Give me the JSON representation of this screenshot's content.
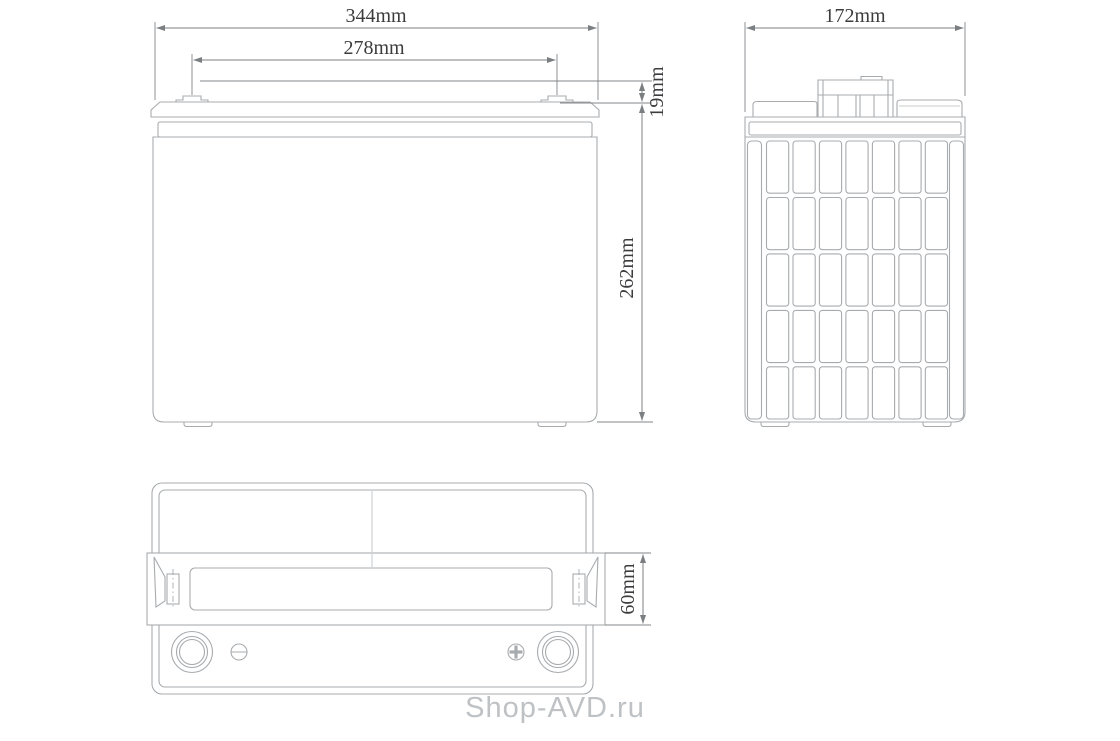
{
  "watermark": {
    "text": "Shop-AVD.ru",
    "color": "#bfc2c5"
  },
  "colors": {
    "background": "#ffffff",
    "drawing_line": "#a8abae",
    "dimension_line": "#7c7f82",
    "dimension_text": "#3c3c3e"
  },
  "views": {
    "front_view": {
      "dimensions": {
        "overall_width": "344mm",
        "terminal_center_spacing": "278mm",
        "terminal_height": "19mm",
        "container_height": "262mm"
      }
    },
    "side_view": {
      "dimensions": {
        "overall_depth": "172mm"
      },
      "rib_grid": {
        "columns": 7,
        "rows": 5
      }
    },
    "top_view": {
      "dimensions": {
        "handle_band_height": "60mm"
      }
    }
  }
}
